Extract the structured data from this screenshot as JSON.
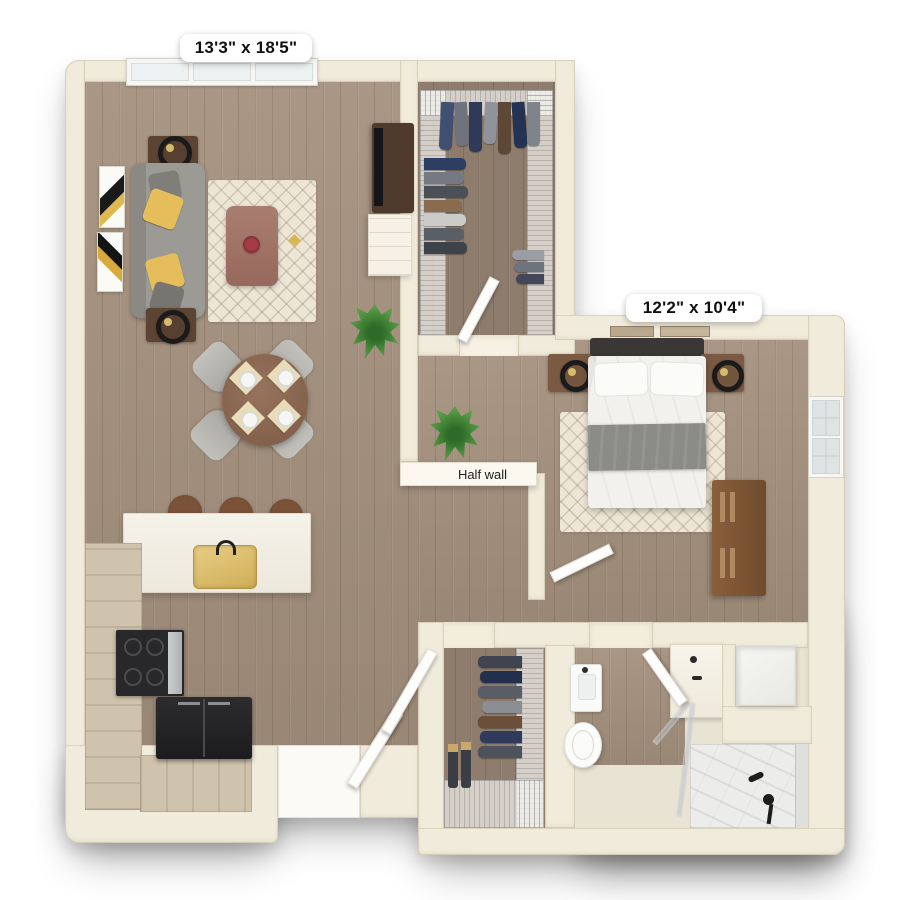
{
  "floor_plan": {
    "living_room": {
      "dimensions_label": "13'3\" x 18'5\""
    },
    "bedroom": {
      "dimensions_label": "12'2\" x 10'4\""
    },
    "annotations": {
      "half_wall_label": "Half wall"
    }
  },
  "colors": {
    "wall": "#f1ebdb",
    "wall_shade": "#e3dac6",
    "floor_wood": "#a5917e",
    "floor_wood_dark": "#8e7c6d",
    "floor_tile": "#e9e3d4",
    "rug": "#ede6d6",
    "sofa": "#9b9a95",
    "accent_pillow": "#e5bd5a",
    "wood_furniture": "#7a5a42",
    "cabinet_wood": "#cfc3ae",
    "appliance_black": "#232325",
    "brass": "#d8bb6a",
    "plant": "#4f9140",
    "marble": "#ececea",
    "bed_linen": "#f2f1ed",
    "throw_gray": "#8b8b88"
  }
}
